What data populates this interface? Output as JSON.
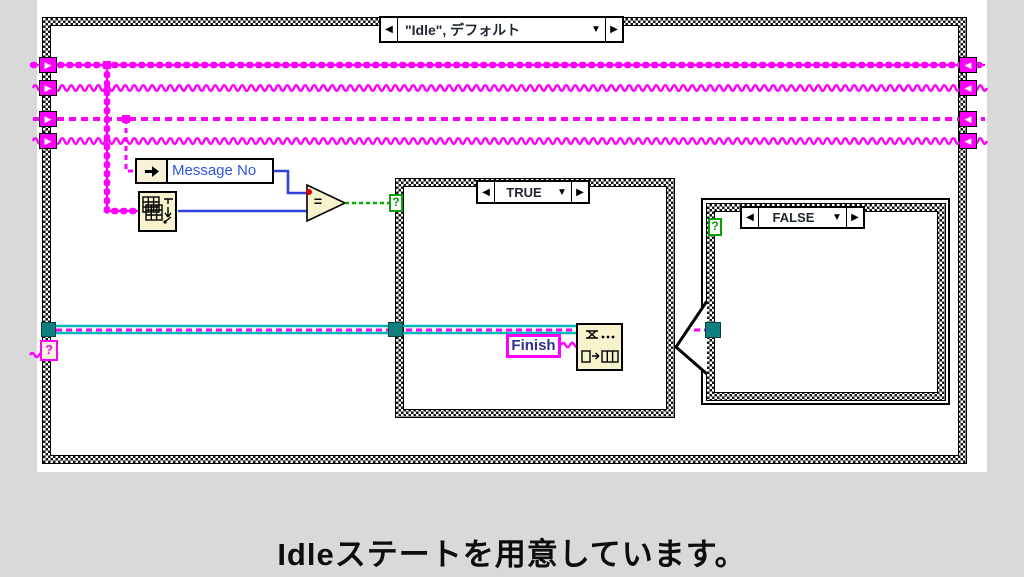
{
  "glyphs": {
    "arrow_left": "◀",
    "arrow_right": "▶",
    "arrow_down": "▼",
    "tunnel_arrow_right": "▶",
    "tunnel_arrow_left": "◀"
  },
  "outer_case": {
    "selector_label": "\"Idle\", デフォルト",
    "selector_terminal": "?"
  },
  "true_case": {
    "selector_label": "TRUE",
    "selector_terminal": "?"
  },
  "false_case": {
    "selector_label": "FALSE",
    "selector_terminal": "?"
  },
  "nodes": {
    "message_no_label": "Message No",
    "equals_symbol": "=",
    "finish_text": "Finish"
  },
  "caption": "Idleステートを用意しています。",
  "colors": {
    "wire_magenta": "#ff00ff",
    "wire_blue": "#3142dc",
    "wire_teal": "#00b9b9",
    "wire_green": "#00b400",
    "node_fill": "#f7f3cd",
    "background_gray": "#d9d9d9"
  }
}
